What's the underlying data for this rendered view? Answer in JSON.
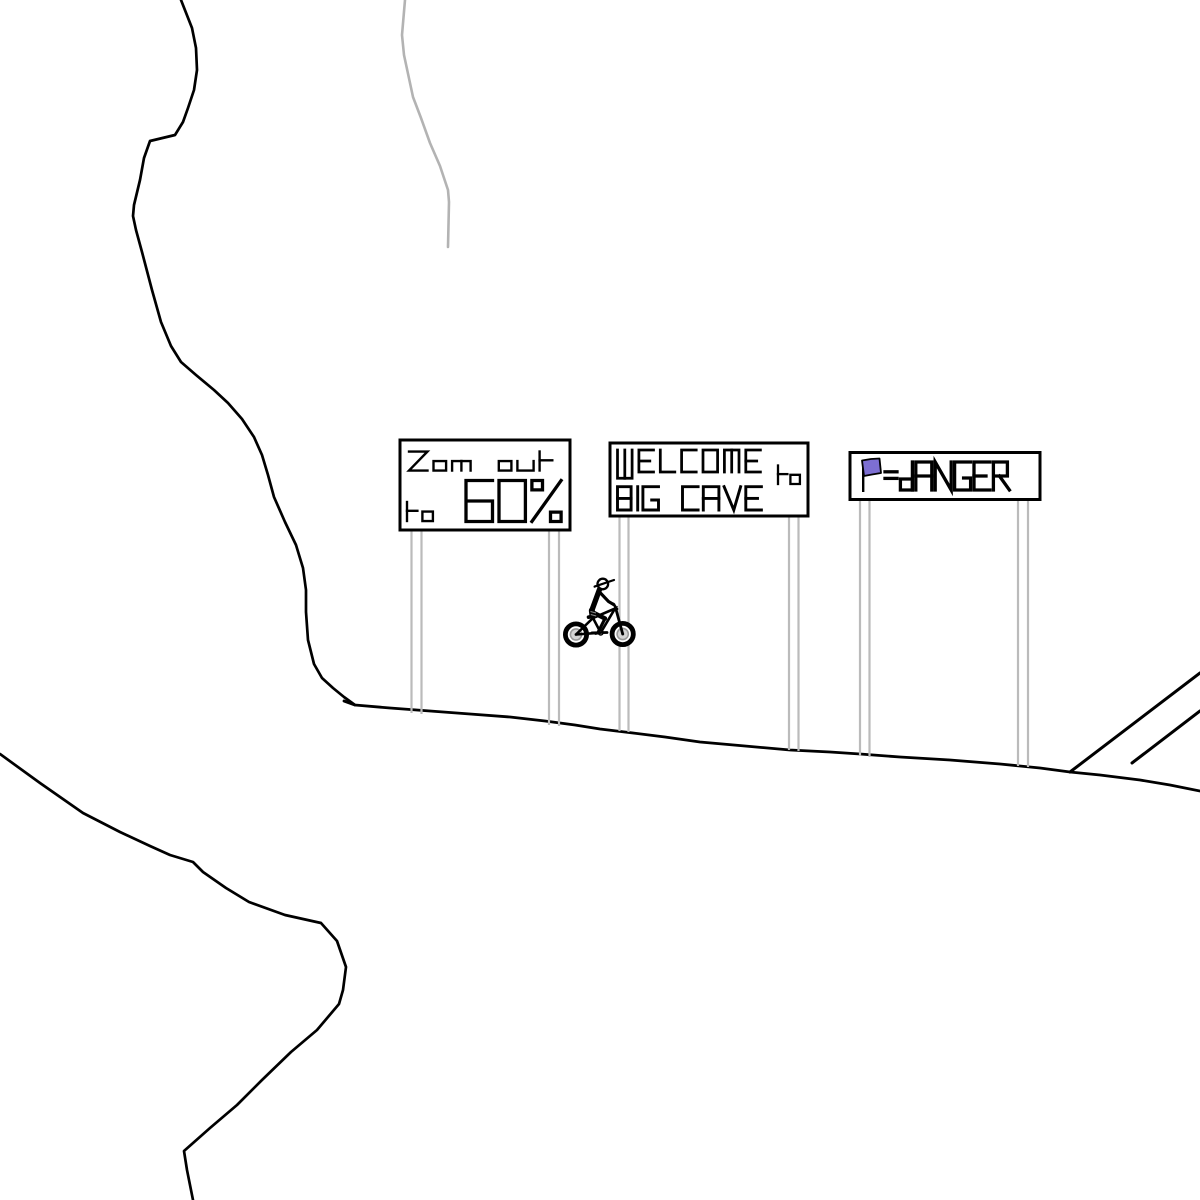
{
  "colors": {
    "ink": "#000000",
    "background": "#ffffff",
    "hint_line_gray": "#b3b3b3",
    "sign_post_gray": "#bbbbbb",
    "flag_purple": "#7d6fd2",
    "wheel_hub_gray": "#d4d4d4",
    "wheel_hub_ring": "#9a9a9a"
  },
  "signs": {
    "zoom_sign": {
      "line1": "Zom out",
      "line2_prefix": "to",
      "line2_value": "60%"
    },
    "welcome_sign": {
      "line1": "WELCOME",
      "connector": "to",
      "line2": "BIG CAVE"
    },
    "danger_sign": {
      "flag_icon": "purple-flag",
      "text": "=dANGER"
    }
  },
  "rider": {
    "icon": "bmx-stick-rider"
  }
}
